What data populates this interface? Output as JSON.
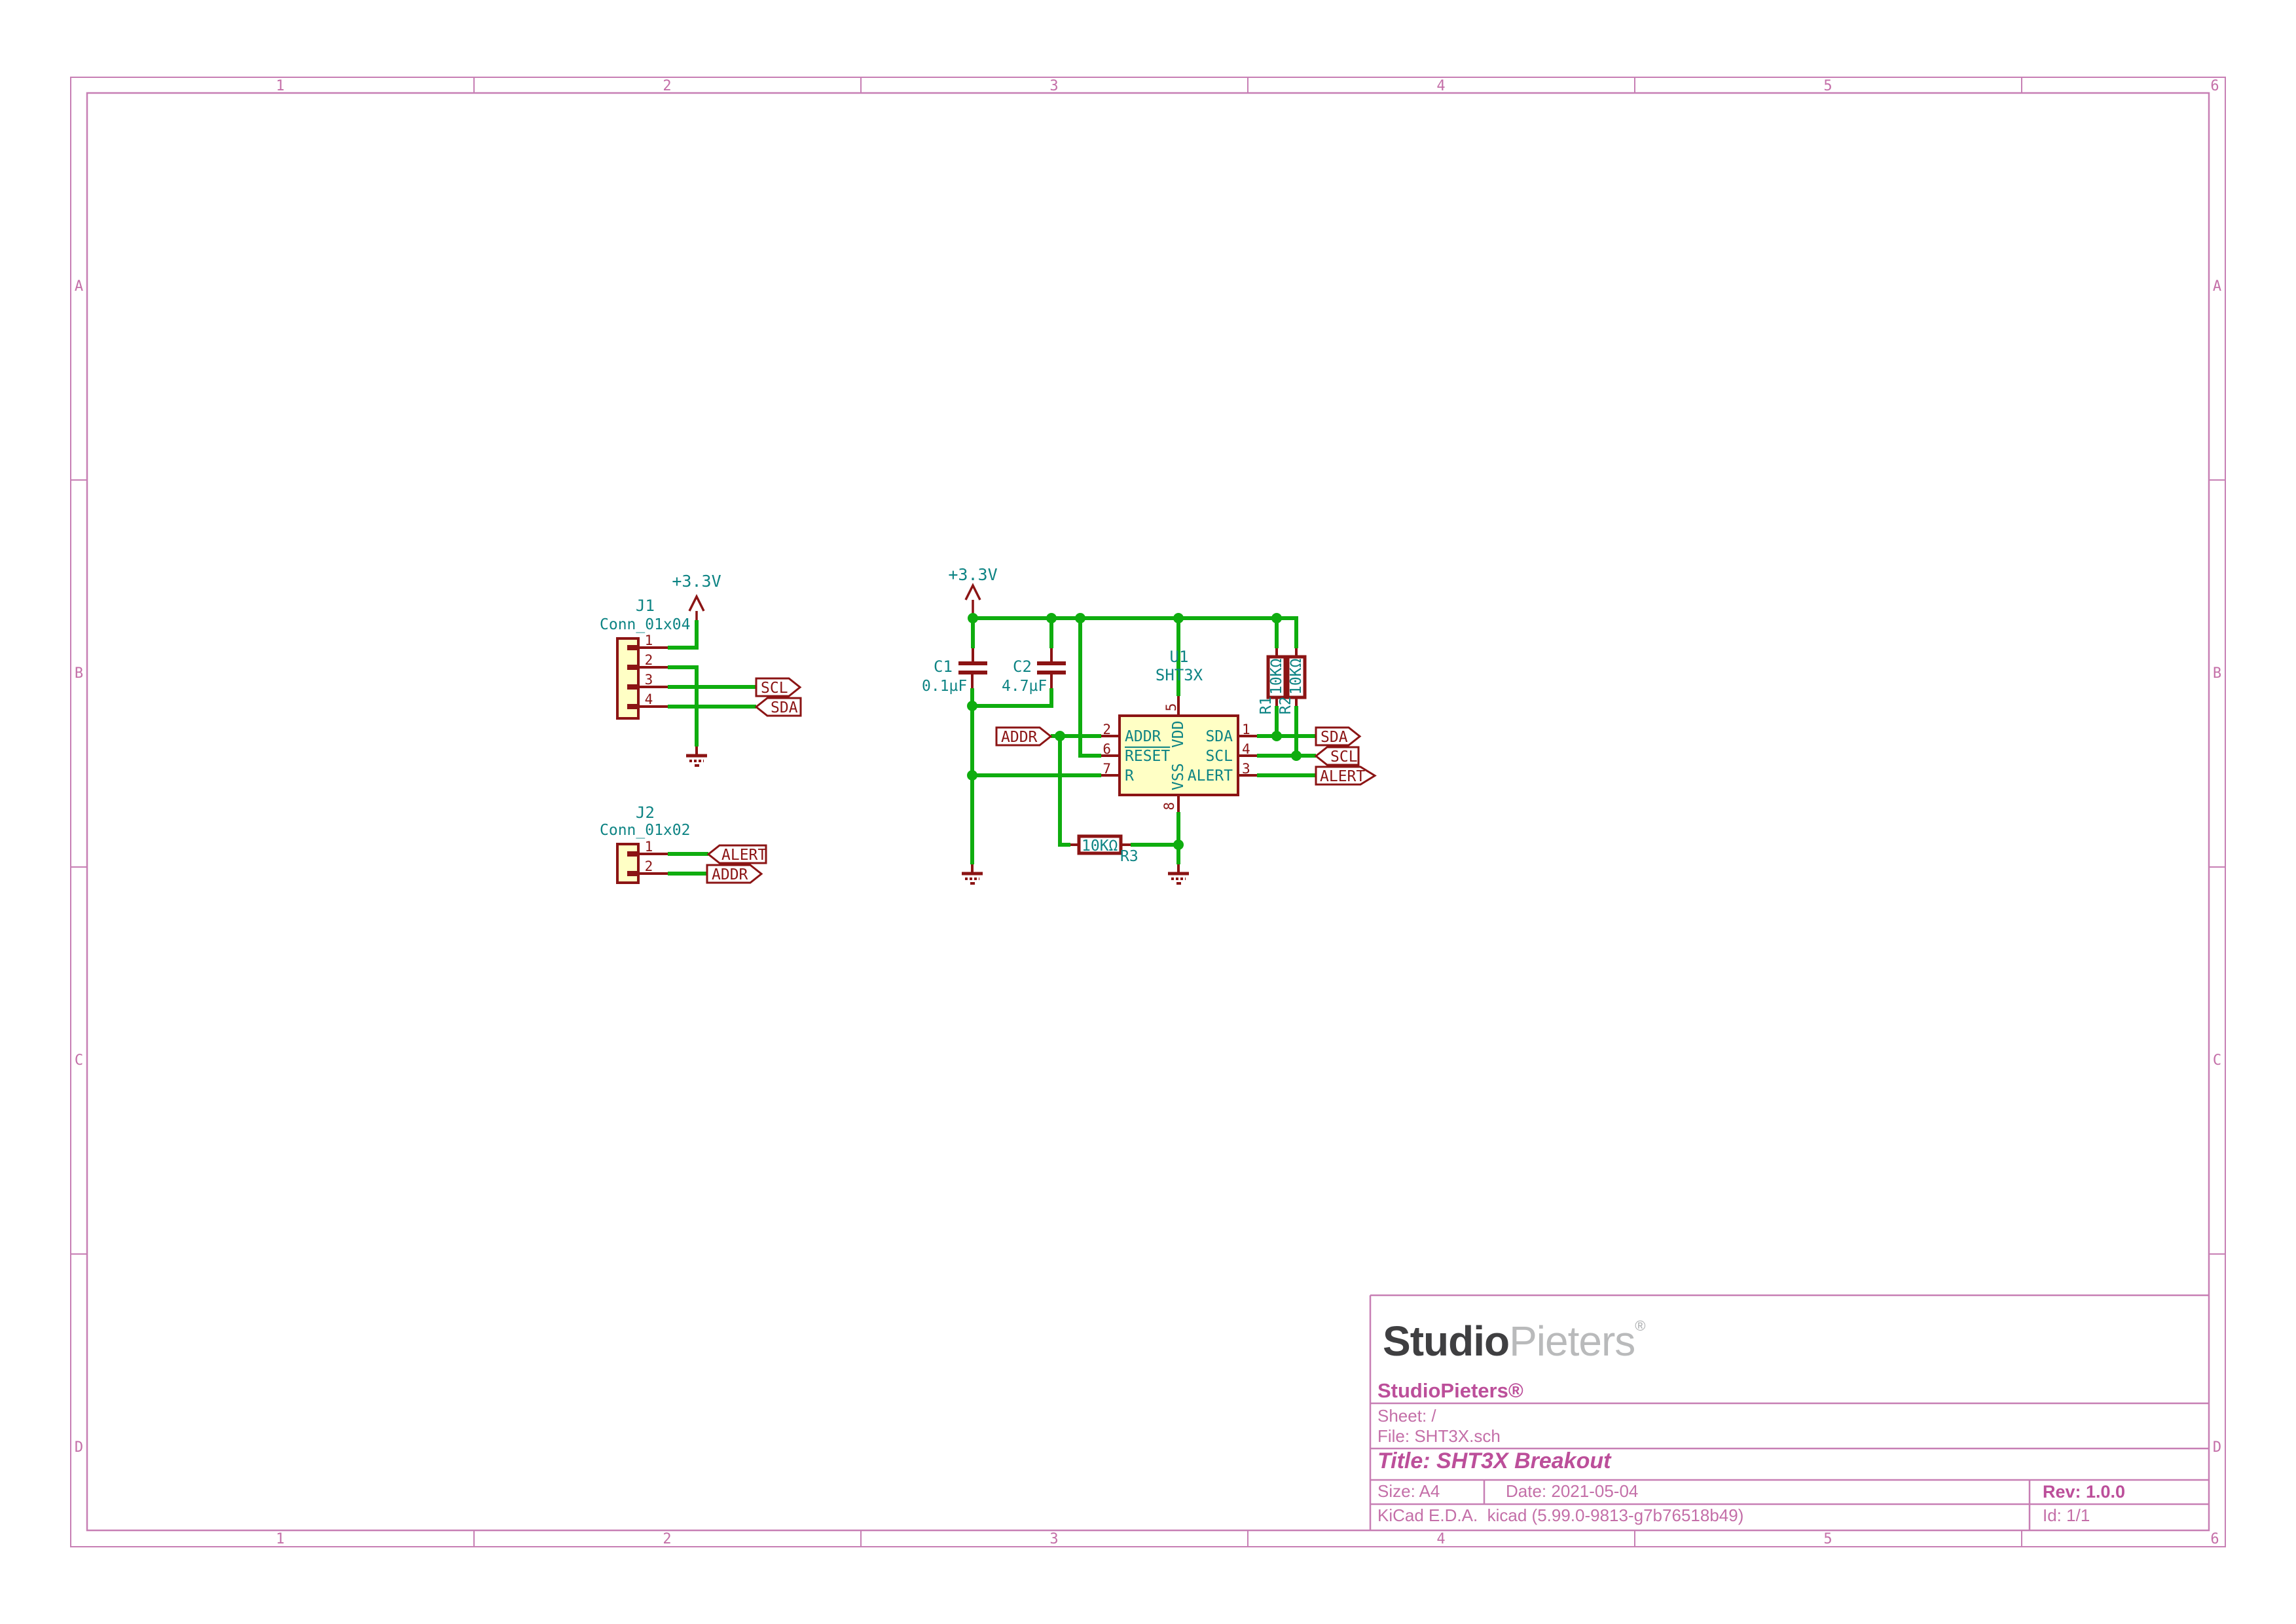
{
  "colors": {
    "pink": "#C77FB4",
    "pinktext": "#C46FA8",
    "pinkbold": "#BC4F9A",
    "red": "#8B1414",
    "teal": "#0E8484",
    "green": "#0FAD0F",
    "fill": "#FFFFC5",
    "logodark": "#3F3F41",
    "logolight": "#B9BABB"
  },
  "frame": {
    "columns": [
      "1",
      "2",
      "3",
      "4",
      "5",
      "6"
    ],
    "rows": [
      "A",
      "B",
      "C",
      "D"
    ]
  },
  "power": {
    "v33": "+3.3V"
  },
  "labels": {
    "scl": "SCL",
    "sda": "SDA",
    "alert": "ALERT",
    "addr": "ADDR"
  },
  "components": {
    "j1": {
      "ref": "J1",
      "value": "Conn_01x04",
      "pins": [
        "1",
        "2",
        "3",
        "4"
      ]
    },
    "j2": {
      "ref": "J2",
      "value": "Conn_01x02",
      "pins": [
        "1",
        "2"
      ]
    },
    "u1": {
      "ref": "U1",
      "value": "SHT3X",
      "pin_numbers": {
        "p1": "1",
        "p2": "2",
        "p3": "3",
        "p4": "4",
        "p5": "5",
        "p6": "6",
        "p7": "7",
        "p8": "8"
      },
      "pin_names": {
        "addr": "ADDR",
        "reset": "RESET",
        "r": "R",
        "sda": "SDA",
        "scl": "SCL",
        "alert": "ALERT",
        "vdd": "VDD",
        "vss": "VSS"
      }
    },
    "c1": {
      "ref": "C1",
      "value": "0.1µF"
    },
    "c2": {
      "ref": "C2",
      "value": "4.7µF"
    },
    "r1": {
      "ref": "R1",
      "value": "10KΩ"
    },
    "r2": {
      "ref": "R2",
      "value": "10KΩ"
    },
    "r3": {
      "ref": "R3",
      "value": "10KΩ"
    }
  },
  "title_block": {
    "logo": {
      "bold": "Studio",
      "light": "Pieters",
      "reg": "®"
    },
    "company": "StudioPieters®",
    "sheet": "Sheet: /",
    "file": "File: SHT3X.sch",
    "title": "Title: SHT3X Breakout",
    "size": "Size: A4",
    "date": "Date: 2021-05-04",
    "rev": "Rev: 1.0.0",
    "tool": "KiCad E.D.A.  kicad (5.99.0-9813-g7b76518b49)",
    "id": "Id: 1/1"
  }
}
